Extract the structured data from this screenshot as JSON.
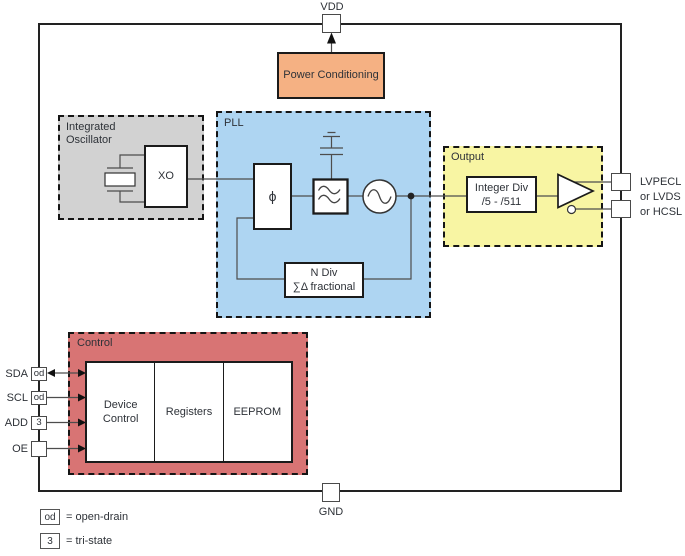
{
  "vdd": {
    "label": "VDD"
  },
  "gnd": {
    "label": "GND"
  },
  "power": {
    "label": "Power Conditioning"
  },
  "oscillator": {
    "title": "Integrated Oscillator",
    "xo": "XO"
  },
  "pll": {
    "title": "PLL",
    "phase_detector_symbol": "ϕ",
    "cap_value": "10 nF",
    "vco_range": "VCO: 4.6 GHz ~ 5.6 GHz",
    "n_divider": {
      "line1": "N Div",
      "line2": "∑Δ fractional"
    }
  },
  "output": {
    "title": "Output",
    "divider": {
      "line1": "Integer Div",
      "line2": "/5 - /511"
    },
    "signal_types": [
      "LVPECL",
      "or LVDS",
      "or HCSL"
    ]
  },
  "control": {
    "title": "Control",
    "blocks": [
      "Device Control",
      "Registers",
      "EEPROM"
    ],
    "pins": [
      {
        "label": "SDA",
        "tag": "od"
      },
      {
        "label": "SCL",
        "tag": "od"
      },
      {
        "label": "ADD",
        "tag": "3"
      },
      {
        "label": "OE",
        "tag": ""
      }
    ]
  },
  "legend": {
    "open_drain": {
      "tag": "od",
      "meaning": "= open-drain"
    },
    "tri_state": {
      "tag": "3",
      "meaning": "= tri-state"
    }
  },
  "colors": {
    "power": "#F5B183",
    "oscillator": "#D2D2D2",
    "pll": "#AED5F2",
    "output": "#F8F5A3",
    "control": "#D87474"
  }
}
